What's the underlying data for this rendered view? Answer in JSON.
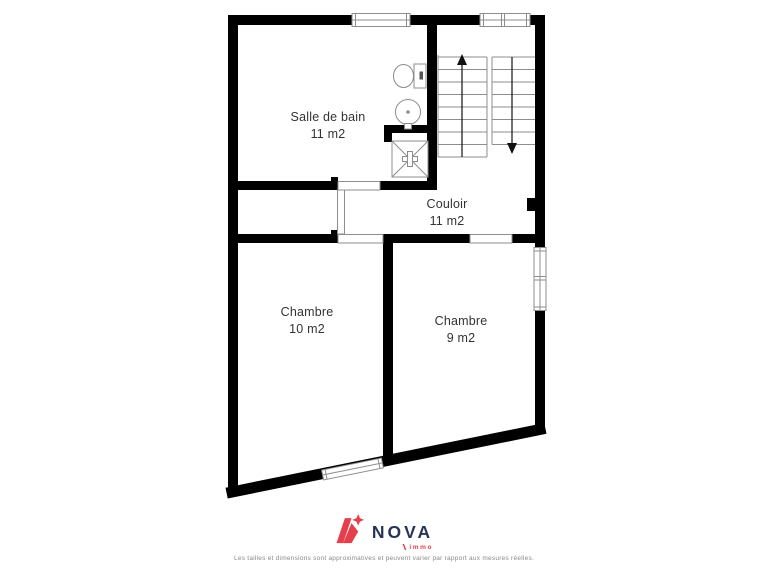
{
  "plan": {
    "rooms": [
      {
        "id": "salle-de-bain",
        "name": "Salle de bain",
        "area": "11 m2"
      },
      {
        "id": "couloir",
        "name": "Couloir",
        "area": "11 m2"
      },
      {
        "id": "chambre-10",
        "name": "Chambre",
        "area": "10 m2"
      },
      {
        "id": "chambre-9",
        "name": "Chambre",
        "area": "9 m2"
      }
    ],
    "icons": {
      "toilet": "toilet-icon",
      "sink": "sink-icon",
      "shower": "shower-icon",
      "stairs_up_arrow": "stairs-up-arrow-icon",
      "stairs_down_arrow": "stairs-down-arrow-icon",
      "logo_mark": "nova-n-star-icon"
    }
  },
  "branding": {
    "name": "NOVA",
    "sub": "immo"
  },
  "footer": {
    "disclaimer": "Les tailles et dimensions sont approximatives et peuvent varier par rapport aux mesures réelles."
  },
  "colors": {
    "wall": "#000000",
    "line": "#8d8d8d",
    "label_text": "#333333",
    "brand_red": "#e63e4b",
    "brand_navy": "#27345a",
    "disclaimer": "#8a8a8a"
  }
}
